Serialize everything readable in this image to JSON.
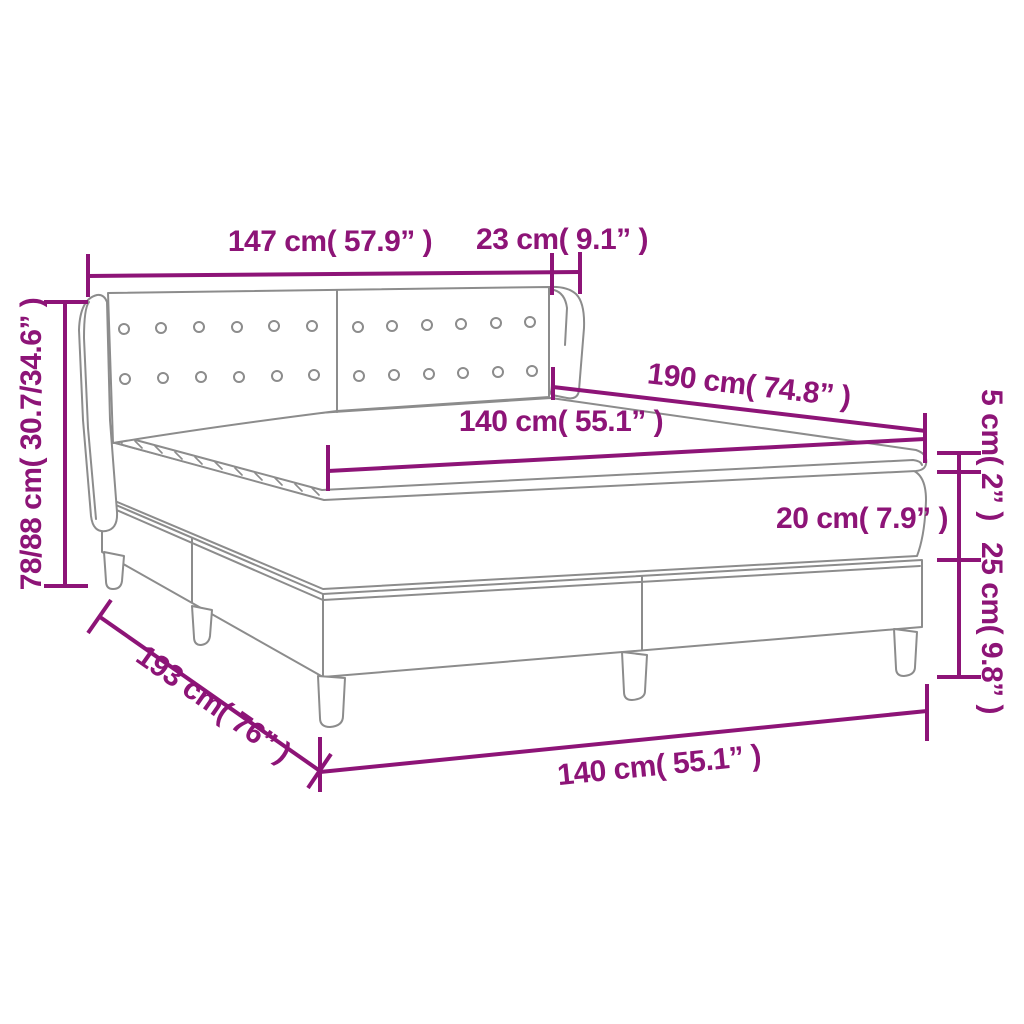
{
  "figure": {
    "title": "Box spring bed dimension diagram",
    "subject": "box-spring bed with button-tufted winged headboard, mattress, topper, two-section base and legs"
  },
  "colors": {
    "dimension_accent": "#8d1477",
    "drawing_outline": "#8c8c8c",
    "background": "#ffffff"
  },
  "labels": {
    "headboard_width": "147 cm( 57.9” )",
    "headboard_side_depth": "23 cm( 9.1” )",
    "bed_height": "78/88 cm( 30.7/34.6” )",
    "mattress_length": "190 cm( 74.8” )",
    "mattress_width": "140 cm( 55.1” )",
    "topper_thickness": "5 cm( 2” )",
    "mattress_thickness": "20 cm( 7.9” )",
    "base_height": "25 cm( 9.8” )",
    "base_length": "193 cm( 76” )",
    "base_width": "140 cm( 55.1” )"
  }
}
